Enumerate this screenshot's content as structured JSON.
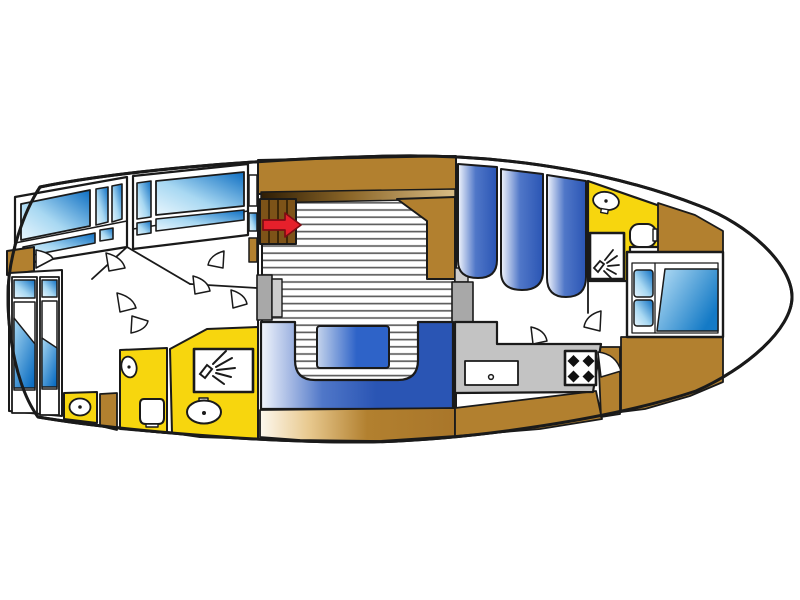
{
  "diagram": {
    "kind": "yacht-floor-plan",
    "orientation": "bow-right",
    "rooms": {
      "aft_cabin": {
        "name": "aft cabin",
        "fixtures": [
          "berth-port",
          "berth-starboard",
          "hull-windows",
          "wardrobe"
        ]
      },
      "aft_bathroom": {
        "name": "aft bathroom",
        "fixtures": [
          "vanity-washbasin",
          "washbasin-small",
          "toilet",
          "shower",
          "washbasin-large"
        ]
      },
      "wheelhouse": {
        "name": "wheelhouse saloon",
        "fixtures": [
          "companionway-stairs",
          "entry-arrow",
          "teak-deck"
        ]
      },
      "cockpit": {
        "name": "cockpit seating",
        "fixtures": [
          "u-shaped-sofa",
          "table"
        ]
      },
      "saloon": {
        "name": "saloon settees",
        "fixtures": [
          "settee-1",
          "settee-2",
          "settee-3"
        ]
      },
      "galley": {
        "name": "galley",
        "fixtures": [
          "counter",
          "sink",
          "stove-4-burner"
        ]
      },
      "fore_bathroom": {
        "name": "fore bathroom",
        "fixtures": [
          "washbasin",
          "toilet",
          "shower"
        ]
      },
      "fore_cabin": {
        "name": "fore cabin",
        "fixtures": [
          "double-bed",
          "pillows",
          "duvet"
        ]
      }
    }
  },
  "colors": {
    "background": "#ffffff",
    "outline": "#1a1a1a",
    "hull_fill": "#ffffff",
    "wood_brown": "#b2802f",
    "wood_cream": "#fdf8ee",
    "stair_brown": "#7d5318",
    "stair_shadow": "#2e1d05",
    "stair_mid": "#8a6527",
    "stair_light": "#d9bc85",
    "room_yellow": "#f7d60e",
    "galley_gray": "#c3c3c3",
    "post_gray": "#a8a8a8",
    "post_gray_light": "#cdcdcd",
    "upholstery_light": "#f2f5fc",
    "upholstery_mid": "#5077c8",
    "upholstery_blue": "#2a55b4",
    "table_light": "#c5d4ec",
    "table_blue": "#2e63c8",
    "glass_light": "#e9f6fd",
    "glass_mid": "#a8d8f2",
    "glass_blue": "#0d6ec2",
    "duvet_light": "#b9e0f6",
    "duvet_blue": "#147ac6",
    "arrow_red": "#e6202b",
    "arrow_dark": "#7e0c13",
    "deck_line": "#5f5f5f"
  }
}
